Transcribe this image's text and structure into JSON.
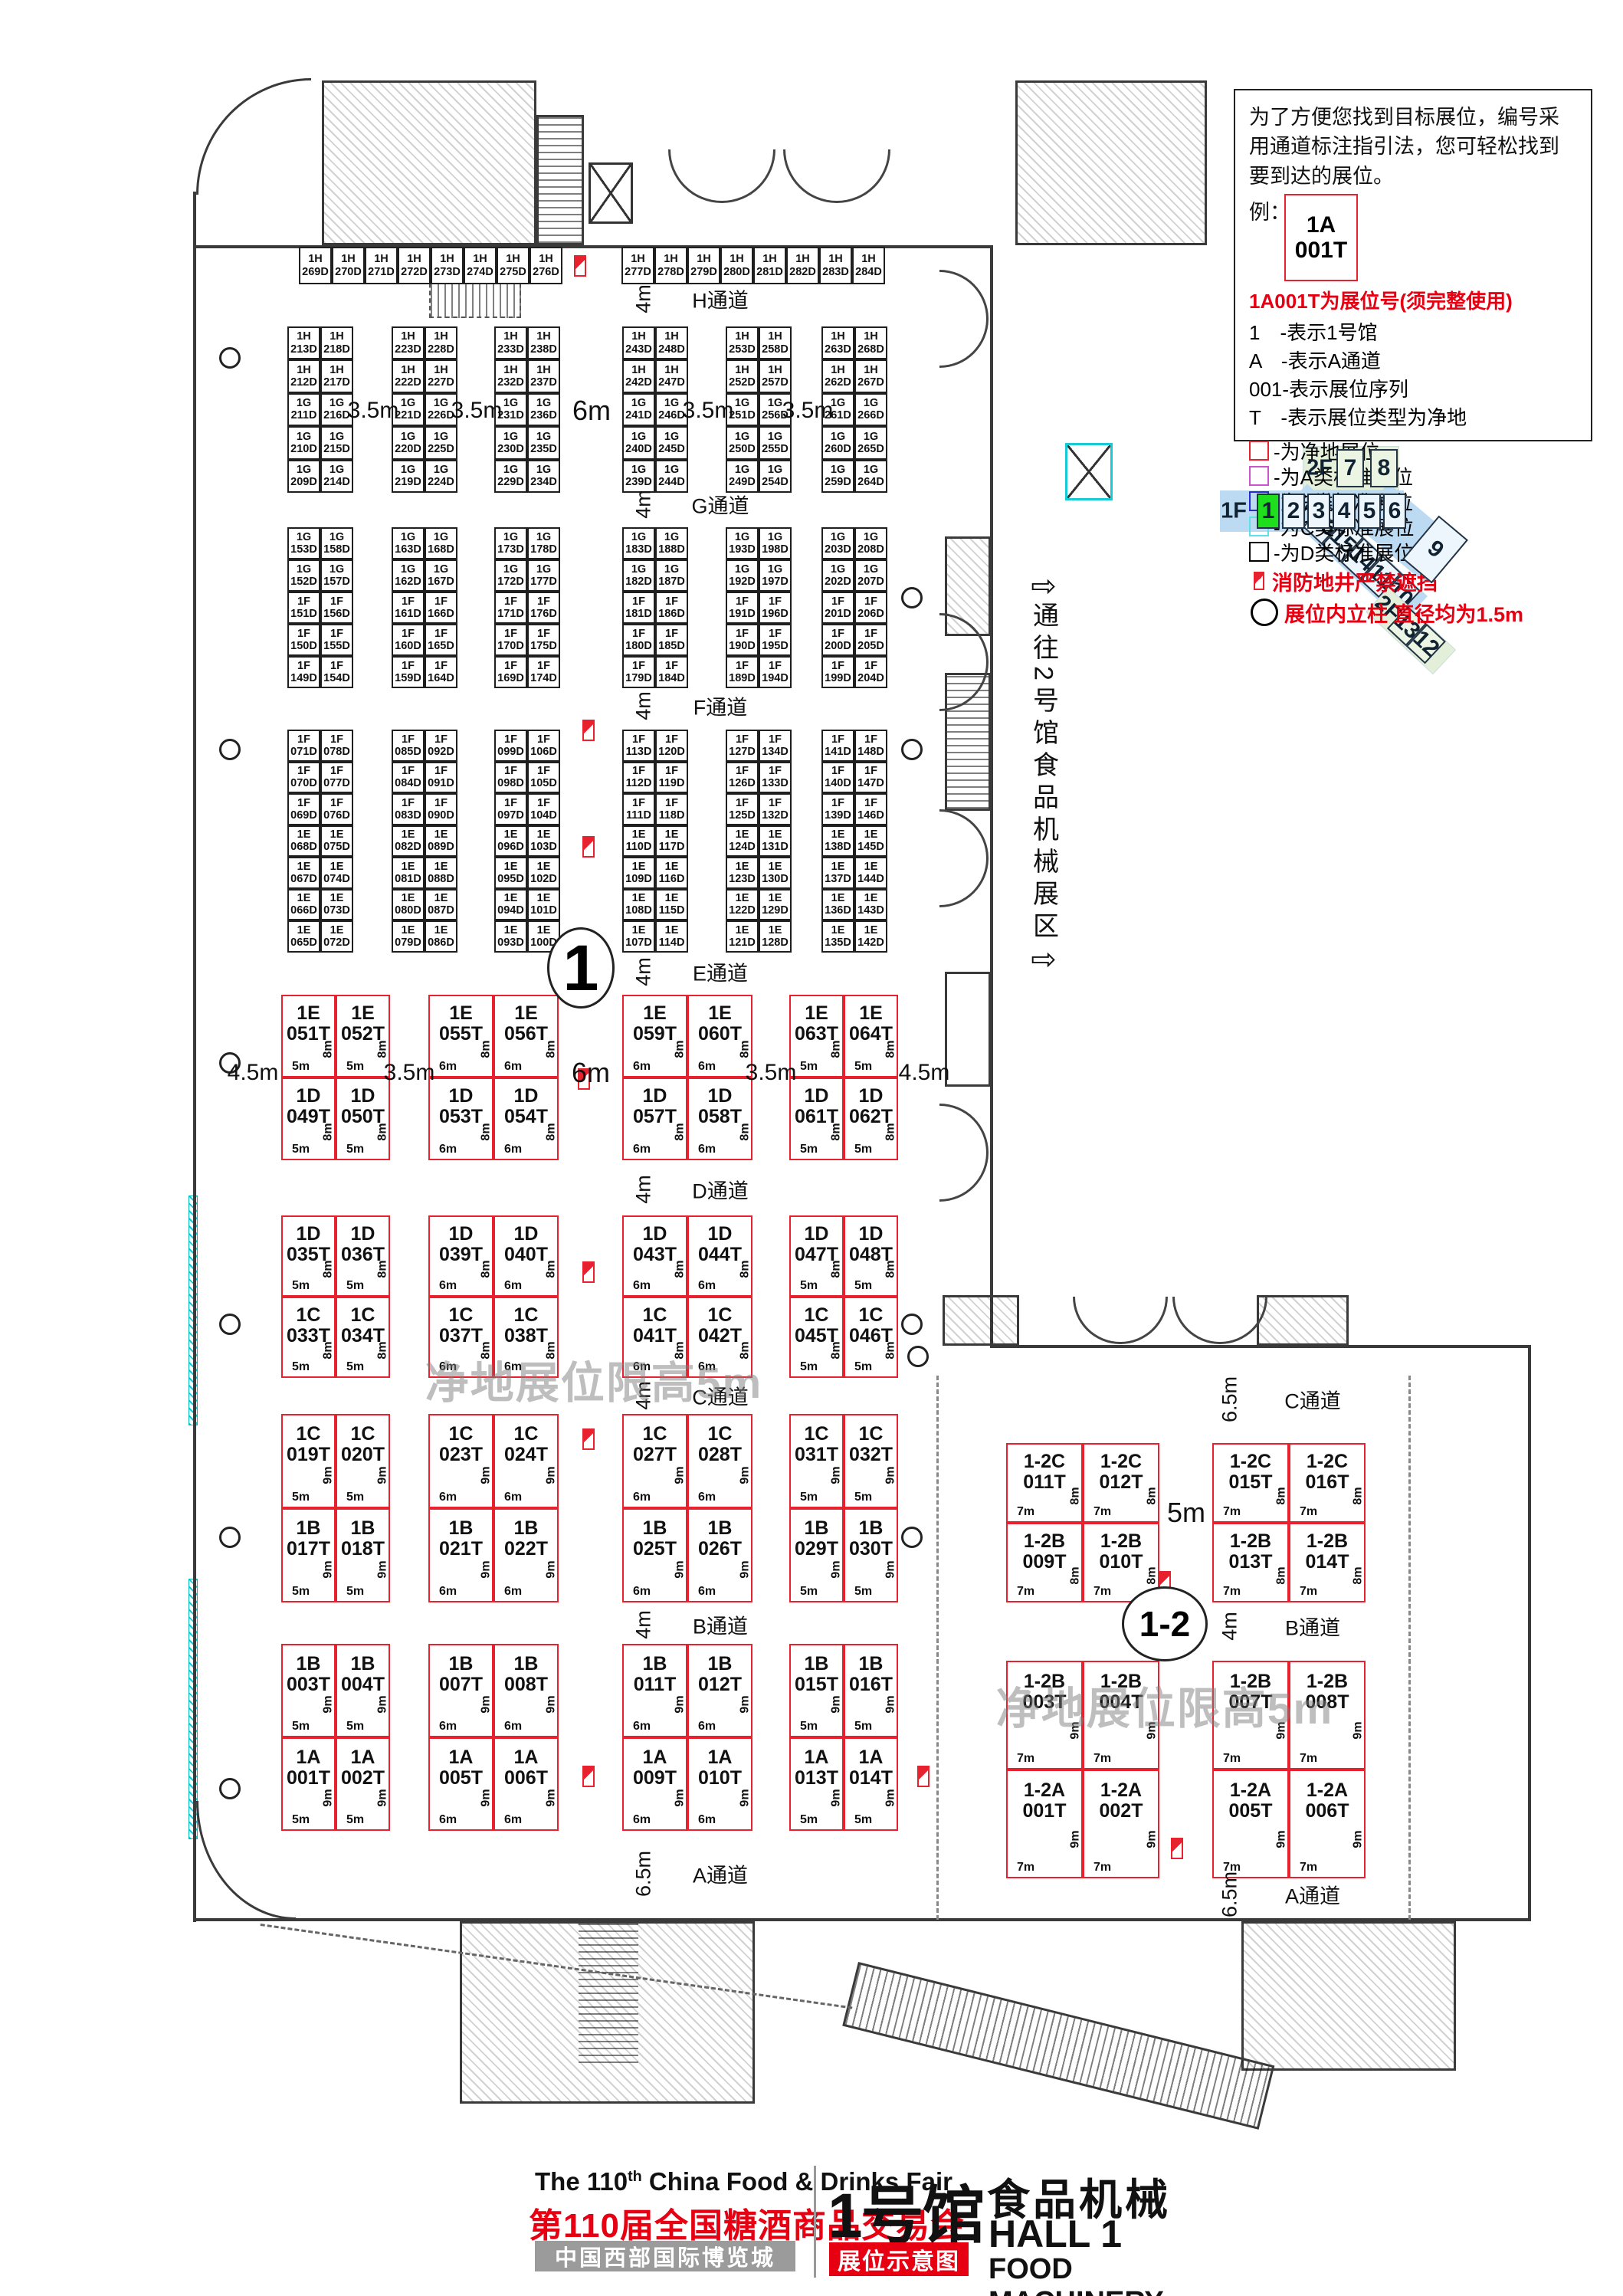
{
  "legend": {
    "intro": [
      "为了方便您找到目标展位，编号采",
      "用通道标注指引法，您可轻松找到",
      "要到达的展位。",
      "例："
    ],
    "example": {
      "line1": "1A",
      "line2": "001T"
    },
    "headline": "1A001T为展位号(须完整使用)",
    "rules": [
      "1　-表示1号馆",
      "A　-表示A通道",
      "001-表示展位序列",
      "T　-表示展位类型为净地"
    ],
    "swatches": [
      {
        "color": "#e8212e",
        "label": "-为净地展位"
      },
      {
        "color": "#cc55cc",
        "label": "-为A类标准展位"
      },
      {
        "color": "#2a2ad4",
        "label": "-为B类标准展位"
      },
      {
        "color": "#5ee0e8",
        "label": "-为C类标准展位"
      },
      {
        "color": "#000000",
        "label": "-为D类标准展位"
      }
    ],
    "fire_note": "消防地井严禁遮挡",
    "pillar_note": "展位内立柱 直径均为1.5m"
  },
  "mini_map": {
    "f2_label": "2F",
    "f2_cells": [
      "7",
      "8"
    ],
    "f1_label": "1F",
    "f1_cells": [
      "1",
      "2",
      "3",
      "4",
      "5",
      "6"
    ],
    "highlight": "1",
    "hall9": "9",
    "diag_cells": [
      "1F",
      "16",
      "15",
      "14",
      "11",
      "10"
    ],
    "diag2_cells": [
      "2F",
      "13",
      "12"
    ],
    "highlight_color": "#1ede1e"
  },
  "side_note": {
    "arrow": "⇨",
    "text": "通往2号馆食品机械展区"
  },
  "badges": {
    "hall1": "1",
    "hall12": "1-2"
  },
  "watermark": "净地展位限高5m",
  "aisles": {
    "main": [
      {
        "name": "H通道",
        "width": "4m"
      },
      {
        "name": "G通道",
        "width": "4m"
      },
      {
        "name": "F通道",
        "width": "4m"
      },
      {
        "name": "E通道",
        "width": "4m"
      },
      {
        "name": "D通道",
        "width": "4m"
      },
      {
        "name": "C通道",
        "width": "4m"
      },
      {
        "name": "B通道",
        "width": "4m"
      },
      {
        "name": "A通道",
        "width": "6.5m"
      }
    ],
    "wing": [
      {
        "name": "C通道",
        "width": "6.5m"
      },
      {
        "name": "B通道",
        "width": "4m"
      },
      {
        "name": "A通道",
        "width": "6.5m"
      }
    ]
  },
  "dims": {
    "hg": [
      "3.5m",
      "3.5m",
      "6m",
      "3.5m",
      "3.5m"
    ],
    "ed": [
      "4.5m",
      "3.5m",
      "6m",
      "3.5m",
      "4.5m"
    ],
    "wing": "5m"
  },
  "booths": {
    "top_h_row": {
      "left": [
        "1H 269D",
        "1H 270D",
        "1H 271D",
        "1H 272D",
        "1H 273D",
        "1H 274D",
        "1H 275D",
        "1H 276D"
      ],
      "right": [
        "1H 277D",
        "1H 278D",
        "1H 279D",
        "1H 280D",
        "1H 281D",
        "1H 282D",
        "1H 283D",
        "1H 284D"
      ]
    },
    "group_hg": [
      [
        [
          "1H 213D",
          "1H 218D"
        ],
        [
          "1H 212D",
          "1H 217D"
        ],
        [
          "1G 211D",
          "1G 216D"
        ],
        [
          "1G 210D",
          "1G 215D"
        ],
        [
          "1G 209D",
          "1G 214D"
        ]
      ],
      [
        [
          "1H 223D",
          "1H 228D"
        ],
        [
          "1H 222D",
          "1H 227D"
        ],
        [
          "1G 221D",
          "1G 226D"
        ],
        [
          "1G 220D",
          "1G 225D"
        ],
        [
          "1G 219D",
          "1G 224D"
        ]
      ],
      [
        [
          "1H 233D",
          "1H 238D"
        ],
        [
          "1H 232D",
          "1H 237D"
        ],
        [
          "1G 231D",
          "1G 236D"
        ],
        [
          "1G 230D",
          "1G 235D"
        ],
        [
          "1G 229D",
          "1G 234D"
        ]
      ],
      [
        [
          "1H 243D",
          "1H 248D"
        ],
        [
          "1H 242D",
          "1H 247D"
        ],
        [
          "1G 241D",
          "1G 246D"
        ],
        [
          "1G 240D",
          "1G 245D"
        ],
        [
          "1G 239D",
          "1G 244D"
        ]
      ],
      [
        [
          "1H 253D",
          "1H 258D"
        ],
        [
          "1H 252D",
          "1H 257D"
        ],
        [
          "1G 251D",
          "1G 256D"
        ],
        [
          "1G 250D",
          "1G 255D"
        ],
        [
          "1G 249D",
          "1G 254D"
        ]
      ],
      [
        [
          "1H 263D",
          "1H 268D"
        ],
        [
          "1H 262D",
          "1H 267D"
        ],
        [
          "1G 261D",
          "1G 266D"
        ],
        [
          "1G 260D",
          "1G 265D"
        ],
        [
          "1G 259D",
          "1G 264D"
        ]
      ]
    ],
    "group_gf": [
      [
        [
          "1G 153D",
          "1G 158D"
        ],
        [
          "1G 152D",
          "1G 157D"
        ],
        [
          "1F 151D",
          "1F 156D"
        ],
        [
          "1F 150D",
          "1F 155D"
        ],
        [
          "1F 149D",
          "1F 154D"
        ]
      ],
      [
        [
          "1G 163D",
          "1G 168D"
        ],
        [
          "1G 162D",
          "1G 167D"
        ],
        [
          "1F 161D",
          "1F 166D"
        ],
        [
          "1F 160D",
          "1F 165D"
        ],
        [
          "1F 159D",
          "1F 164D"
        ]
      ],
      [
        [
          "1G 173D",
          "1G 178D"
        ],
        [
          "1G 172D",
          "1G 177D"
        ],
        [
          "1F 171D",
          "1F 176D"
        ],
        [
          "1F 170D",
          "1F 175D"
        ],
        [
          "1F 169D",
          "1F 174D"
        ]
      ],
      [
        [
          "1G 183D",
          "1G 188D"
        ],
        [
          "1G 182D",
          "1G 187D"
        ],
        [
          "1F 181D",
          "1F 186D"
        ],
        [
          "1F 180D",
          "1F 185D"
        ],
        [
          "1F 179D",
          "1F 184D"
        ]
      ],
      [
        [
          "1G 193D",
          "1G 198D"
        ],
        [
          "1G 192D",
          "1G 197D"
        ],
        [
          "1F 191D",
          "1F 196D"
        ],
        [
          "1F 190D",
          "1F 195D"
        ],
        [
          "1F 189D",
          "1F 194D"
        ]
      ],
      [
        [
          "1G 203D",
          "1G 208D"
        ],
        [
          "1G 202D",
          "1G 207D"
        ],
        [
          "1F 201D",
          "1F 206D"
        ],
        [
          "1F 200D",
          "1F 205D"
        ],
        [
          "1F 199D",
          "1F 204D"
        ]
      ]
    ],
    "group_fe": [
      [
        [
          "1F 071D",
          "1F 078D"
        ],
        [
          "1F 070D",
          "1F 077D"
        ],
        [
          "1F 069D",
          "1F 076D"
        ],
        [
          "1E 068D",
          "1E 075D"
        ],
        [
          "1E 067D",
          "1E 074D"
        ],
        [
          "1E 066D",
          "1E 073D"
        ],
        [
          "1E 065D",
          "1E 072D"
        ]
      ],
      [
        [
          "1F 085D",
          "1F 092D"
        ],
        [
          "1F 084D",
          "1F 091D"
        ],
        [
          "1F 083D",
          "1F 090D"
        ],
        [
          "1E 082D",
          "1E 089D"
        ],
        [
          "1E 081D",
          "1E 088D"
        ],
        [
          "1E 080D",
          "1E 087D"
        ],
        [
          "1E 079D",
          "1E 086D"
        ]
      ],
      [
        [
          "1F 099D",
          "1F 106D"
        ],
        [
          "1F 098D",
          "1F 105D"
        ],
        [
          "1F 097D",
          "1F 104D"
        ],
        [
          "1E 096D",
          "1E 103D"
        ],
        [
          "1E 095D",
          "1E 102D"
        ],
        [
          "1E 094D",
          "1E 101D"
        ],
        [
          "1E 093D",
          "1E 100D"
        ]
      ],
      [
        [
          "1F 113D",
          "1F 120D"
        ],
        [
          "1F 112D",
          "1F 119D"
        ],
        [
          "1F 111D",
          "1F 118D"
        ],
        [
          "1E 110D",
          "1E 117D"
        ],
        [
          "1E 109D",
          "1E 116D"
        ],
        [
          "1E 108D",
          "1E 115D"
        ],
        [
          "1E 107D",
          "1E 114D"
        ]
      ],
      [
        [
          "1F 127D",
          "1F 134D"
        ],
        [
          "1F 126D",
          "1F 133D"
        ],
        [
          "1F 125D",
          "1F 132D"
        ],
        [
          "1E 124D",
          "1E 131D"
        ],
        [
          "1E 123D",
          "1E 130D"
        ],
        [
          "1E 122D",
          "1E 129D"
        ],
        [
          "1E 121D",
          "1E 128D"
        ]
      ],
      [
        [
          "1F 141D",
          "1F 148D"
        ],
        [
          "1F 140D",
          "1F 147D"
        ],
        [
          "1F 139D",
          "1F 146D"
        ],
        [
          "1E 138D",
          "1E 145D"
        ],
        [
          "1E 137D",
          "1E 144D"
        ],
        [
          "1E 136D",
          "1E 143D"
        ],
        [
          "1E 135D",
          "1E 142D"
        ]
      ]
    ],
    "red_ed": [
      {
        "w": "5m",
        "h": "8m",
        "top": [
          "1E 051T",
          "1E 052T"
        ],
        "bottom": [
          "1D 049T",
          "1D 050T"
        ]
      },
      {
        "w": "6m",
        "h": "8m",
        "top": [
          "1E 055T",
          "1E 056T"
        ],
        "bottom": [
          "1D 053T",
          "1D 054T"
        ]
      },
      {
        "w": "6m",
        "h": "8m",
        "top": [
          "1E 059T",
          "1E 060T"
        ],
        "bottom": [
          "1D 057T",
          "1D 058T"
        ]
      },
      {
        "w": "5m",
        "h": "8m",
        "top": [
          "1E 063T",
          "1E 064T"
        ],
        "bottom": [
          "1D 061T",
          "1D 062T"
        ]
      }
    ],
    "red_dc": [
      {
        "w": "5m",
        "h": "8m",
        "top": [
          "1D 035T",
          "1D 036T"
        ],
        "bottom": [
          "1C 033T",
          "1C 034T"
        ]
      },
      {
        "w": "6m",
        "h": "8m",
        "top": [
          "1D 039T",
          "1D 040T"
        ],
        "bottom": [
          "1C 037T",
          "1C 038T"
        ]
      },
      {
        "w": "6m",
        "h": "8m",
        "top": [
          "1D 043T",
          "1D 044T"
        ],
        "bottom": [
          "1C 041T",
          "1C 042T"
        ]
      },
      {
        "w": "5m",
        "h": "8m",
        "top": [
          "1D 047T",
          "1D 048T"
        ],
        "bottom": [
          "1C 045T",
          "1C 046T"
        ]
      }
    ],
    "red_cb": [
      {
        "w": "5m",
        "h": "9m",
        "top": [
          "1C 019T",
          "1C 020T"
        ],
        "bottom": [
          "1B 017T",
          "1B 018T"
        ]
      },
      {
        "w": "6m",
        "h": "9m",
        "top": [
          "1C 023T",
          "1C 024T"
        ],
        "bottom": [
          "1B 021T",
          "1B 022T"
        ]
      },
      {
        "w": "6m",
        "h": "9m",
        "top": [
          "1C 027T",
          "1C 028T"
        ],
        "bottom": [
          "1B 025T",
          "1B 026T"
        ]
      },
      {
        "w": "5m",
        "h": "9m",
        "top": [
          "1C 031T",
          "1C 032T"
        ],
        "bottom": [
          "1B 029T",
          "1B 030T"
        ]
      }
    ],
    "red_ba": [
      {
        "w": "5m",
        "h": "9m",
        "top": [
          "1B 003T",
          "1B 004T"
        ],
        "bottom": [
          "1A 001T",
          "1A 002T"
        ]
      },
      {
        "w": "6m",
        "h": "9m",
        "top": [
          "1B 007T",
          "1B 008T"
        ],
        "bottom": [
          "1A 005T",
          "1A 006T"
        ]
      },
      {
        "w": "6m",
        "h": "9m",
        "top": [
          "1B 011T",
          "1B 012T"
        ],
        "bottom": [
          "1A 009T",
          "1A 010T"
        ]
      },
      {
        "w": "5m",
        "h": "9m",
        "top": [
          "1B 015T",
          "1B 016T"
        ],
        "bottom": [
          "1A 013T",
          "1A 014T"
        ]
      }
    ],
    "wing_c": [
      {
        "w": "7m",
        "h": "8m",
        "top": [
          "1-2C 011T",
          "1-2C 012T"
        ],
        "bottom": [
          "1-2B 009T",
          "1-2B 010T"
        ]
      },
      {
        "w": "7m",
        "h": "8m",
        "top": [
          "1-2C 015T",
          "1-2C 016T"
        ],
        "bottom": [
          "1-2B 013T",
          "1-2B 014T"
        ]
      }
    ],
    "wing_a": [
      {
        "w": "7m",
        "h": "9m",
        "top": [
          "1-2B 003T",
          "1-2B 004T"
        ],
        "bottom": [
          "1-2A 001T",
          "1-2A 002T"
        ]
      },
      {
        "w": "7m",
        "h": "9m",
        "top": [
          "1-2B 007T",
          "1-2B 008T"
        ],
        "bottom": [
          "1-2A 005T",
          "1-2A 006T"
        ]
      }
    ]
  },
  "title_block": {
    "en_pre": "The 110",
    "en_sup": "th",
    "en_post": " China Food & Drinks Fair",
    "cn": "第110届全国糖酒商品交易会",
    "venue": "中国西部国际博览城",
    "hall_cn": "1号馆",
    "cat_cn": "食品机械",
    "hall_en": "HALL 1",
    "badge": "展位示意图",
    "cat_en": "FOOD MACHINERY"
  }
}
